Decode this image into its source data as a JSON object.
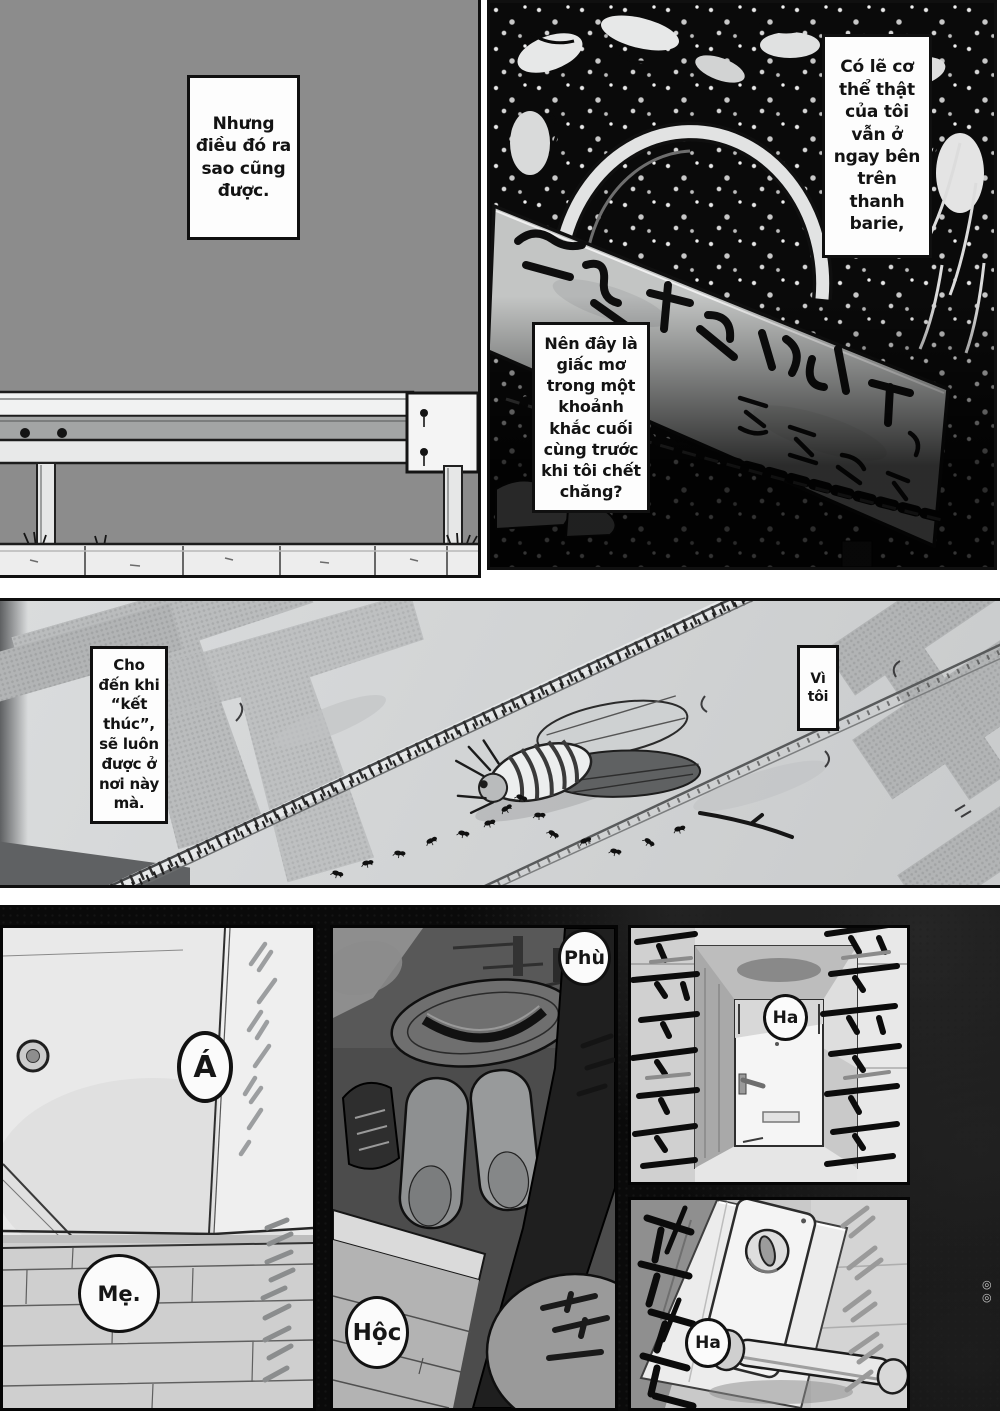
{
  "colors": {
    "ink": "#111111",
    "paper": "#ffffff",
    "panel_gray": "#8c8c8c",
    "night_bg": "#0a0a0a",
    "ground_gray": "#d2d4d5"
  },
  "captions": {
    "top_left": "Nhưng điều đó ra sao cũng được.",
    "top_right": "Có lẽ cơ thể thật của tôi vẫn ở ngay bên trên thanh barie,",
    "mid_right": "Nên đây là giấc mơ trong một khoảnh khắc cuối cùng trước khi tôi chết chăng?",
    "middle_panel_left": "Cho đến khi “kết thúc”, sẽ luôn được ở nơi này mà.",
    "middle_panel_right": "Vì tôi"
  },
  "bubbles": {
    "gasp": "Á",
    "mom": "Mẹ.",
    "sigh": "Phù",
    "pant": "Hộc",
    "breath_1": "Ha",
    "breath_2": "Ha"
  },
  "edge_marks": [
    "◎",
    "◎"
  ]
}
